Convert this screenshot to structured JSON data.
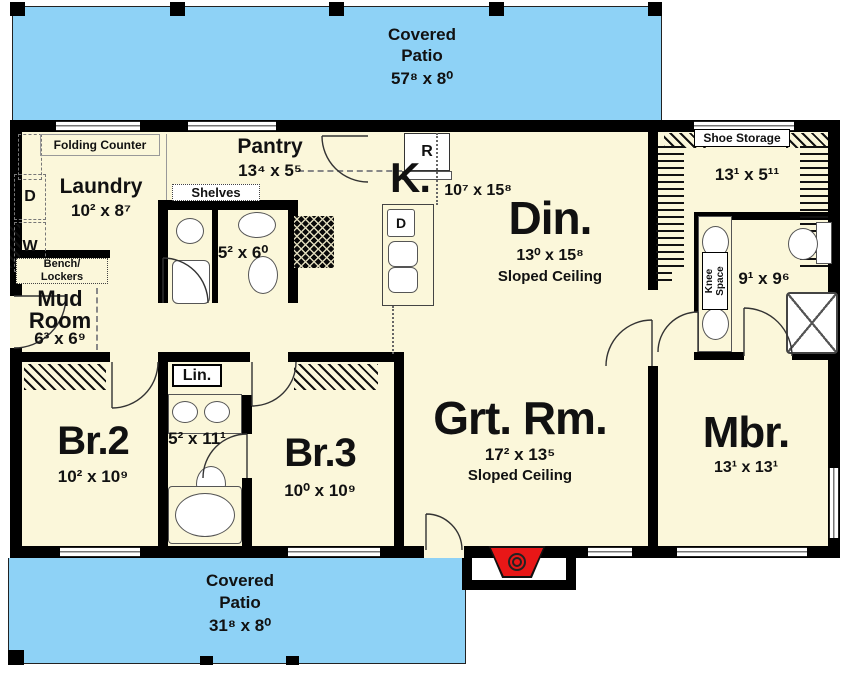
{
  "colors": {
    "patio": "#8ed2f6",
    "floor": "#fbf7da",
    "wall": "#000000",
    "fireplace": "#e81717"
  },
  "patio_top": {
    "title1": "Covered",
    "title2": "Patio",
    "dims": "57⁸ x 8⁰"
  },
  "patio_bottom": {
    "title1": "Covered",
    "title2": "Patio",
    "dims": "31⁸ x 8⁰"
  },
  "laundry": {
    "name": "Laundry",
    "dims": "10² x 8⁷",
    "counter": "Folding Counter",
    "dryer": "D",
    "washer": "W"
  },
  "pantry": {
    "name": "Pantry",
    "dims": "13⁴ x 5⁵",
    "shelves": "Shelves"
  },
  "hall_bath": {
    "dims": "5² x 6⁰"
  },
  "kitchen": {
    "name": "K.",
    "dims": "10⁷ x 15⁸",
    "fridge": "R",
    "dishwasher": "D"
  },
  "dining": {
    "name": "Din.",
    "dims": "13⁰ x 15⁸",
    "note": "Sloped Ceiling"
  },
  "mud_room": {
    "name1": "Mud",
    "name2": "Room",
    "dims": "6³ x 6⁹",
    "bench1": "Bench/",
    "bench2": "Lockers"
  },
  "shoe_closet": {
    "label": "Shoe Storage",
    "dims": "13¹ x 5¹¹"
  },
  "master_bath": {
    "dims": "9¹ x 9⁶",
    "knee1": "Knee",
    "knee2": "Space"
  },
  "br2": {
    "name": "Br.2",
    "dims": "10² x 10⁹"
  },
  "linen": {
    "name": "Lin."
  },
  "shared_bath": {
    "dims": "5² x 11¹"
  },
  "br3": {
    "name": "Br.3",
    "dims": "10⁰ x 10⁹"
  },
  "great_room": {
    "name": "Grt. Rm.",
    "dims": "17² x 13⁵",
    "note": "Sloped Ceiling"
  },
  "master_bedroom": {
    "name": "Mbr.",
    "dims": "13¹ x 13¹"
  }
}
